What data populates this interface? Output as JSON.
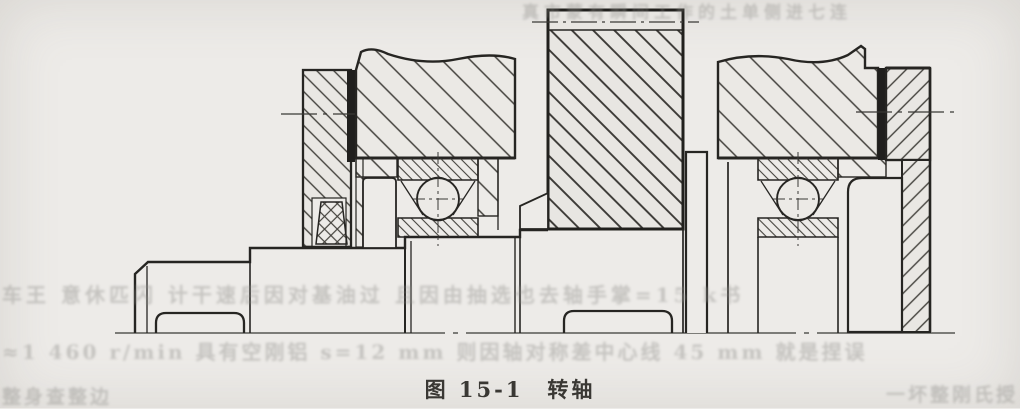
{
  "figure": {
    "caption": "图 15-1　转轴"
  },
  "bleed_text": {
    "top": "真市蒙有瞬间工作的土单侧进七连",
    "row1": "车王 意休匹闪 计干速后因对基油过   且因由抽选也去轴手掌=15 k书",
    "row2": "≈1 460 r/min 具有空刚铝 s=12 mm 则因轴对称差中心线 45 mm 就是捏误",
    "row3_left": "整身查整边",
    "row3_right": "一坏整刚氏授"
  },
  "colors": {
    "paper": "#edebe8",
    "ink": "#262522",
    "hatch": "#44423d",
    "bleed": "#8f8e8a"
  }
}
